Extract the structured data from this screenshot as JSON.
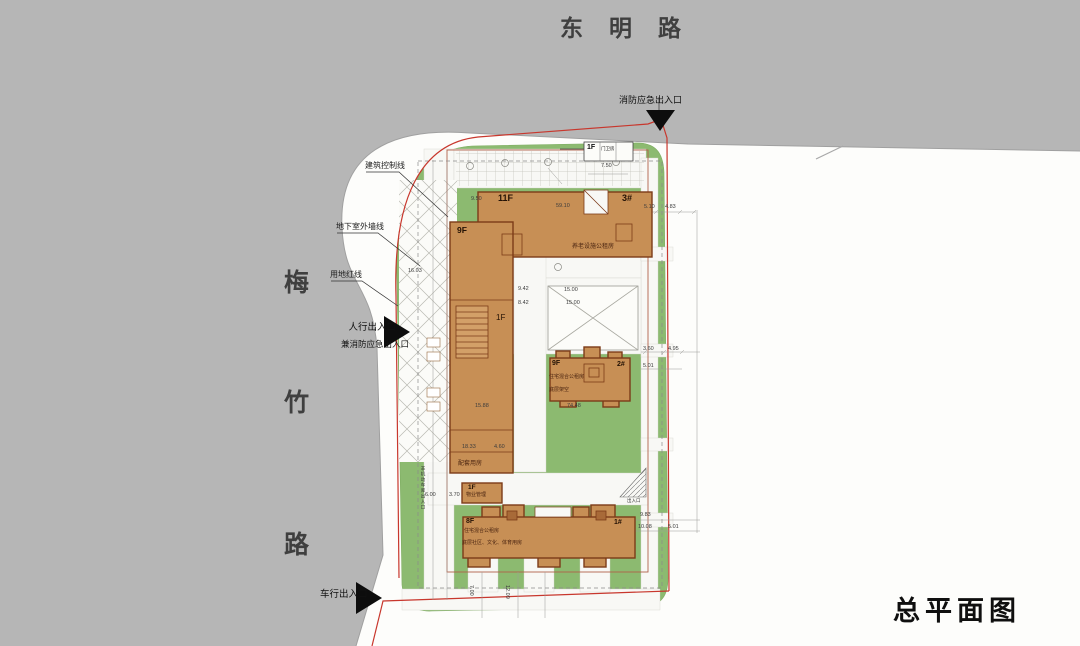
{
  "title": "总平面图",
  "roads": {
    "top": "东明路",
    "left_chars": [
      "梅",
      "竹",
      "路"
    ]
  },
  "entrances": {
    "fire": "消防应急出入口",
    "pedestrian": "人行出入口",
    "pedestrian_sub": "兼消防应急出入口",
    "vehicle": "车行出入口"
  },
  "callouts": {
    "control_line": "建筑控制线",
    "basement_line": "地下室外墙线",
    "red_line": "用地红线"
  },
  "buildings": {
    "b3": {
      "floors": "11F",
      "num": "3#",
      "note": "养老设施公租房"
    },
    "tower": {
      "floors": "9F",
      "ground": "1F",
      "note": "配套用房"
    },
    "b2": {
      "floors": "9F",
      "num": "2#",
      "note1": "住宅混合公租房",
      "note2": "底层架空"
    },
    "b1": {
      "floors": "8F",
      "num": "1#",
      "note1": "住宅混合公租房",
      "note2": "底层社区、文化、体育用房"
    },
    "property": {
      "floors": "1F",
      "label": "物业管理"
    },
    "guard": {
      "floors": "1F",
      "label": "门卫房"
    }
  },
  "small_labels": {
    "bike_garage": "非机动车库出入口",
    "ramp": "出入口"
  },
  "dimensions": [
    {
      "t": "7.50",
      "x": 601,
      "y": 163,
      "r": 0
    },
    {
      "t": "9.50",
      "x": 471,
      "y": 196,
      "r": 0
    },
    {
      "t": "59.10",
      "x": 556,
      "y": 203,
      "r": 0
    },
    {
      "t": "5.10",
      "x": 644,
      "y": 204,
      "r": 0
    },
    {
      "t": "4.83",
      "x": 665,
      "y": 204,
      "r": 0
    },
    {
      "t": "16.03",
      "x": 408,
      "y": 268,
      "r": 0
    },
    {
      "t": "9.42",
      "x": 518,
      "y": 286,
      "r": 0
    },
    {
      "t": "15.00",
      "x": 564,
      "y": 287,
      "r": 0
    },
    {
      "t": "8.42",
      "x": 518,
      "y": 300,
      "r": 0
    },
    {
      "t": "15.00",
      "x": 566,
      "y": 300,
      "r": 0
    },
    {
      "t": "3.60",
      "x": 643,
      "y": 346,
      "r": 0
    },
    {
      "t": "4.95",
      "x": 668,
      "y": 346,
      "r": 0
    },
    {
      "t": "5.01",
      "x": 643,
      "y": 363,
      "r": 0
    },
    {
      "t": "15.88",
      "x": 475,
      "y": 403,
      "r": 0
    },
    {
      "t": "74.48",
      "x": 567,
      "y": 403,
      "r": 0
    },
    {
      "t": "18.33",
      "x": 462,
      "y": 444,
      "r": 0
    },
    {
      "t": "4.60",
      "x": 494,
      "y": 444,
      "r": 0
    },
    {
      "t": "6.00",
      "x": 425,
      "y": 492,
      "r": 0
    },
    {
      "t": "3.70",
      "x": 449,
      "y": 492,
      "r": 0
    },
    {
      "t": "9.83",
      "x": 640,
      "y": 512,
      "r": 0
    },
    {
      "t": "10.08",
      "x": 638,
      "y": 524,
      "r": 0
    },
    {
      "t": "5.01",
      "x": 668,
      "y": 524,
      "r": 0
    },
    {
      "t": "7.00",
      "x": 474,
      "y": 585,
      "r": 90
    },
    {
      "t": "12.09",
      "x": 510,
      "y": 585,
      "r": 90
    }
  ],
  "colors": {
    "road": "#b6b6b6",
    "green": "#8cba70",
    "building": "#c78f55",
    "building-outline": "#7c3b18",
    "red-line": "#c8372d",
    "paper": "#fdfdfb"
  }
}
